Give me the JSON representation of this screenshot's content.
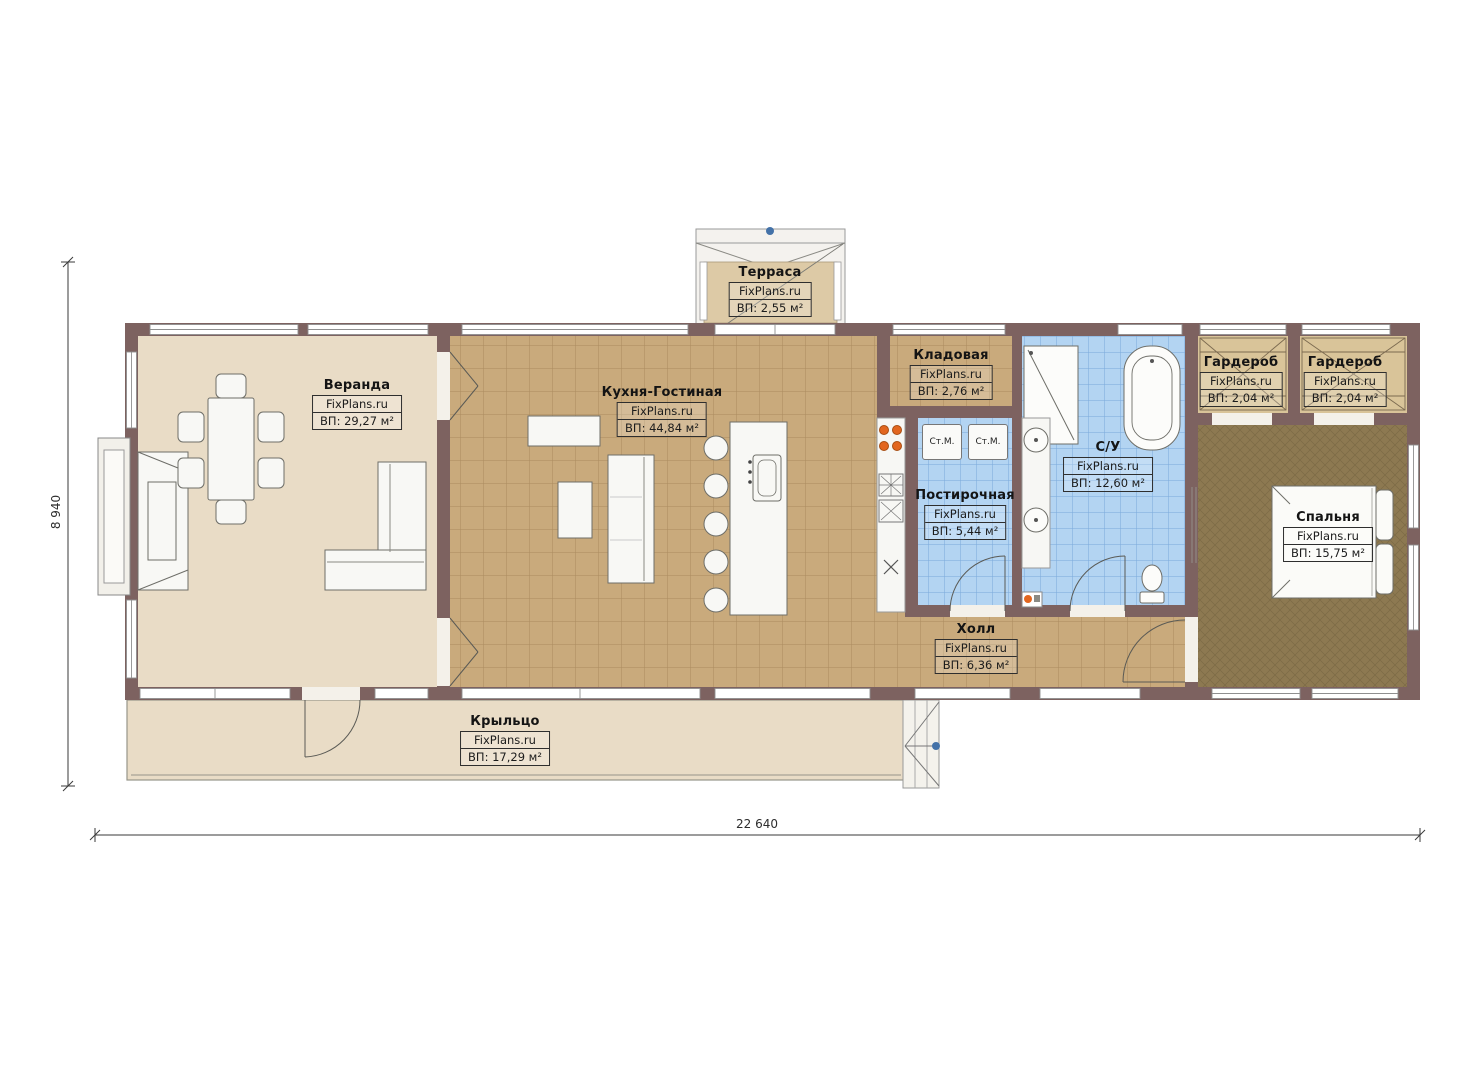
{
  "plan": {
    "brand": "FixPlans.ru",
    "rooms": [
      {
        "id": "terrace",
        "name": "Терраса",
        "brand": "FixPlans.ru",
        "area": "ВП: 2,55 м²"
      },
      {
        "id": "veranda",
        "name": "Веранда",
        "brand": "FixPlans.ru",
        "area": "ВП: 29,27 м²"
      },
      {
        "id": "kitchen-living",
        "name": "Кухня-Гостиная",
        "brand": "FixPlans.ru",
        "area": "ВП: 44,84 м²"
      },
      {
        "id": "storage",
        "name": "Кладовая",
        "brand": "FixPlans.ru",
        "area": "ВП: 2,76 м²"
      },
      {
        "id": "laundry",
        "name": "Постирочная",
        "brand": "FixPlans.ru",
        "area": "ВП: 5,44 м²"
      },
      {
        "id": "bathroom",
        "name": "С/У",
        "brand": "FixPlans.ru",
        "area": "ВП: 12,60 м²"
      },
      {
        "id": "wardrobe-left",
        "name": "Гардероб",
        "brand": "FixPlans.ru",
        "area": "ВП: 2,04 м²"
      },
      {
        "id": "wardrobe-right",
        "name": "Гардероб",
        "brand": "FixPlans.ru",
        "area": "ВП: 2,04 м²"
      },
      {
        "id": "bedroom",
        "name": "Спальня",
        "brand": "FixPlans.ru",
        "area": "ВП: 15,75 м²"
      },
      {
        "id": "hall",
        "name": "Холл",
        "brand": "FixPlans.ru",
        "area": "ВП: 6,36 м²"
      },
      {
        "id": "porch",
        "name": "Крыльцо",
        "brand": "FixPlans.ru",
        "area": "ВП: 17,29 м²"
      }
    ],
    "appliances": {
      "washer_left": "Ст.М.",
      "washer_right": "Ст.М."
    },
    "dimensions": {
      "overall_width": "22 640",
      "overall_height": "8 940"
    },
    "colors": {
      "wall": "#7d6260",
      "floor_light": "#e9dcc6",
      "tile_tan": "#c9aa7c",
      "tile_blue": "#b3d4f2",
      "carpet": "#8d7951",
      "wardrobe": "#d9c499",
      "accent_orange": "#e2661f",
      "marker_blue": "#4472a8"
    }
  }
}
